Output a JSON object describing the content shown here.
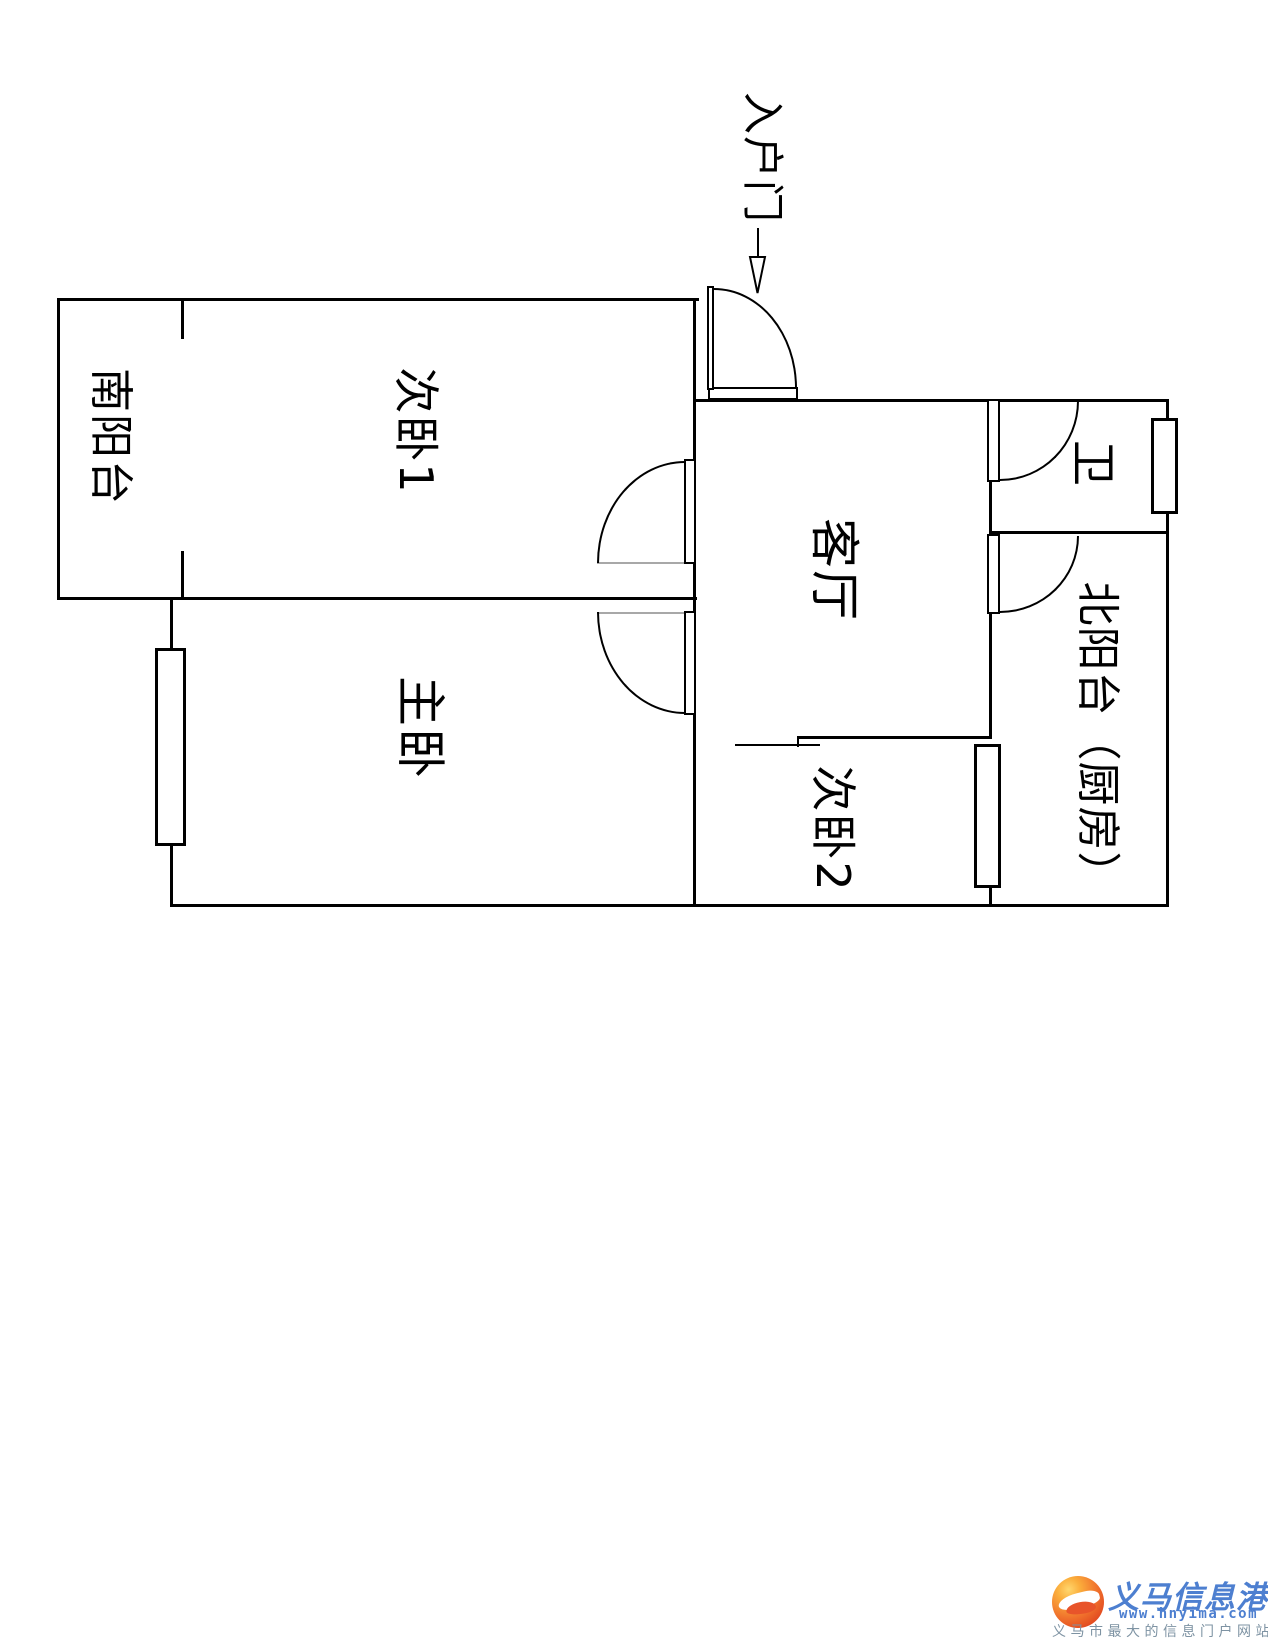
{
  "page": {
    "background": "#ffffff"
  },
  "floorplan": {
    "rooms": [
      {
        "id": "south-balcony",
        "label": "南阳台"
      },
      {
        "id": "bedroom-1",
        "label": "次卧1"
      },
      {
        "id": "master-bedroom",
        "label": "主卧"
      },
      {
        "id": "living-room",
        "label": "客厅"
      },
      {
        "id": "bathroom",
        "label": "卫"
      },
      {
        "id": "north-balcony-kitchen",
        "label": "北阳台（厨房）"
      },
      {
        "id": "bedroom-2",
        "label": "次卧2"
      }
    ],
    "entrance": {
      "label": "入户门"
    },
    "colors": {
      "wall": "#000000",
      "door_swing_line": "#a8a8a8"
    }
  },
  "watermark": {
    "site_name": "义马信息港",
    "site_url": "www.hnyima.com",
    "tagline": "义马市最大的信息门户网站",
    "colors": {
      "brand_blue": "#4d7fd0",
      "tagline_gray": "#7e93a3",
      "logo_orange": "#e8542a"
    }
  }
}
